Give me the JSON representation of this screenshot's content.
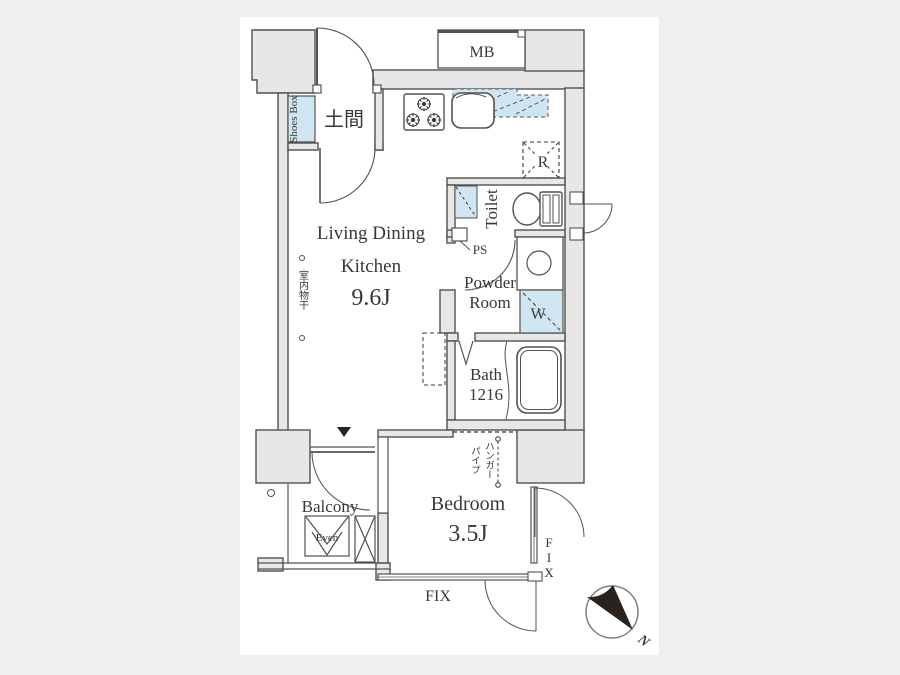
{
  "title": "apartment-floor-plan",
  "colors": {
    "background": "#efefef",
    "canvas": "#ffffff",
    "wall_fill": "#e7e7e7",
    "line": "#55514b",
    "accent_blue": "#cfe6f2",
    "needle": "#2a221d"
  },
  "rooms": {
    "ldk": {
      "line1": "Living Dining",
      "line2": "Kitchen",
      "size": "9.6J"
    },
    "doma": {
      "label": "土間"
    },
    "shoes_box": {
      "label": "Shoes Box"
    },
    "mb": {
      "label": "MB"
    },
    "toilet": {
      "label": "Toilet"
    },
    "ps": {
      "label": "PS"
    },
    "powder": {
      "line1": "Powder",
      "line2": "Room"
    },
    "bath": {
      "line1": "Bath",
      "line2": "1216"
    },
    "bedroom": {
      "label": "Bedroom",
      "size": "3.5J"
    },
    "balcony": {
      "label": "Balcony"
    }
  },
  "fixtures": {
    "refrigerator": {
      "label": "R"
    },
    "washer": {
      "label": "W"
    },
    "evacuation_hatch": {
      "label": "Even"
    },
    "indoor_laundry": {
      "label": "室内物干"
    },
    "hanger_pipe_col1": {
      "label": "ハンガー"
    },
    "hanger_pipe_col2": {
      "label": "パイプ"
    }
  },
  "windows": {
    "fix_bottom": {
      "label": "FIX"
    },
    "fix_right": {
      "label": "FIX"
    }
  },
  "compass": {
    "label": "N"
  }
}
